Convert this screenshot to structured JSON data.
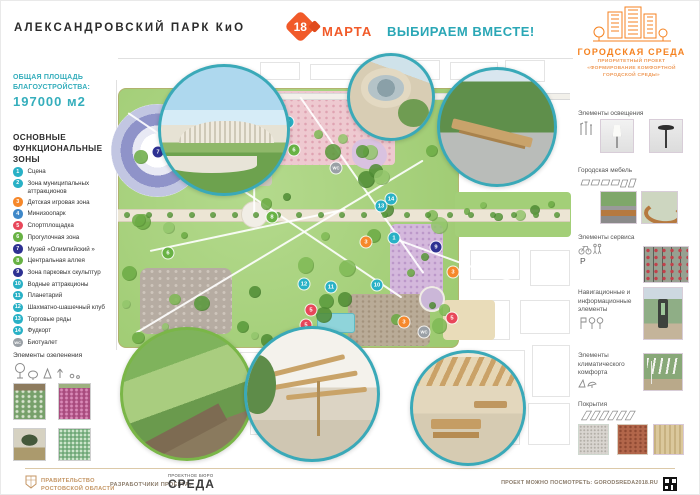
{
  "header": {
    "title": "АЛЕКСАНДРОВСКИЙ ПАРК КиО",
    "date_number": "18",
    "date_word": "МАРТА",
    "slogan": "ВЫБИРАЕМ ВМЕСТЕ!",
    "program_name": "ГОРОДСКАЯ СРЕДА",
    "program_subtitle": "ПРИОРИТЕТНЫЙ ПРОЕКТ «ФОРМИРОВАНИЕ КОМФОРТНОЙ ГОРОДСКОЙ СРЕДЫ»"
  },
  "left_panel": {
    "area_label": "ОБЩАЯ ПЛОЩАДЬ БЛАГОУСТРОЙСТВА:",
    "area_value": "197000 м2",
    "zones_heading": "ОСНОВНЫЕ ФУНКЦИОНАЛЬНЫЕ ЗОНЫ",
    "zones": [
      {
        "num": "1",
        "label": "Сцена",
        "color": "#29b1c6"
      },
      {
        "num": "2",
        "label": "Зона муниципальных аттракционов",
        "color": "#29b1c6"
      },
      {
        "num": "3",
        "label": "Детская игровая зона",
        "color": "#f6882b"
      },
      {
        "num": "4",
        "label": "Минизоопарк",
        "color": "#3f88c9"
      },
      {
        "num": "5",
        "label": "Спортплощадка",
        "color": "#e8475a"
      },
      {
        "num": "6",
        "label": "Прогулочная зона",
        "color": "#68b244"
      },
      {
        "num": "7",
        "label": "Музей «Олимпийский »",
        "color": "#2e3192"
      },
      {
        "num": "8",
        "label": "Центральная аллея",
        "color": "#68b244"
      },
      {
        "num": "9",
        "label": "Зона парковых скульптур",
        "color": "#2e3192"
      },
      {
        "num": "10",
        "label": "Водные аттракционы",
        "color": "#29b1c6"
      },
      {
        "num": "11",
        "label": "Планетарий",
        "color": "#29b1c6"
      },
      {
        "num": "12",
        "label": "Шахматно-шашечный клуб",
        "color": "#29b1c6"
      },
      {
        "num": "13",
        "label": "Торговые ряды",
        "color": "#29b1c6"
      },
      {
        "num": "14",
        "label": "Фудкорт",
        "color": "#29b1c6"
      },
      {
        "num": "WC",
        "label": "Биотуалет",
        "color": "#9aa0a6"
      }
    ],
    "greenery_label": "Элементы озеленения"
  },
  "right_panel": {
    "sections": [
      {
        "title": "Элементы освещения"
      },
      {
        "title": "Городская мебель"
      },
      {
        "title": "Элементы сервиса",
        "parking_letter": "Р"
      },
      {
        "title": "Навигационные и информационные элементы"
      },
      {
        "title": "Элементы климатического комфорта"
      },
      {
        "title": "Покрытия"
      }
    ]
  },
  "map": {
    "markers": [
      {
        "n": "7",
        "x": 158,
        "y": 152,
        "c": "#2e3192"
      },
      {
        "n": "2",
        "x": 288,
        "y": 122,
        "c": "#29b1c6"
      },
      {
        "n": "4",
        "x": 259,
        "y": 155,
        "c": "#3f88c9"
      },
      {
        "n": "6",
        "x": 294,
        "y": 150,
        "c": "#68b244"
      },
      {
        "n": "6",
        "x": 168,
        "y": 253,
        "c": "#68b244"
      },
      {
        "n": "8",
        "x": 272,
        "y": 217,
        "c": "#68b244"
      },
      {
        "n": "13",
        "x": 381,
        "y": 206,
        "c": "#29b1c6"
      },
      {
        "n": "14",
        "x": 391,
        "y": 199,
        "c": "#29b1c6"
      },
      {
        "n": "1",
        "x": 394,
        "y": 238,
        "c": "#29b1c6"
      },
      {
        "n": "3",
        "x": 366,
        "y": 242,
        "c": "#f6882b"
      },
      {
        "n": "9",
        "x": 436,
        "y": 247,
        "c": "#2e3192"
      },
      {
        "n": "3",
        "x": 453,
        "y": 272,
        "c": "#f6882b"
      },
      {
        "n": "10",
        "x": 377,
        "y": 285,
        "c": "#29b1c6"
      },
      {
        "n": "12",
        "x": 304,
        "y": 284,
        "c": "#29b1c6"
      },
      {
        "n": "11",
        "x": 331,
        "y": 287,
        "c": "#29b1c6"
      },
      {
        "n": "3",
        "x": 404,
        "y": 322,
        "c": "#f6882b"
      },
      {
        "n": "5",
        "x": 452,
        "y": 318,
        "c": "#e8475a"
      },
      {
        "n": "5",
        "x": 311,
        "y": 310,
        "c": "#e8475a"
      },
      {
        "n": "5",
        "x": 306,
        "y": 325,
        "c": "#e8475a"
      },
      {
        "n": "WC",
        "x": 336,
        "y": 168,
        "c": "#9aa0a6"
      },
      {
        "n": "WC",
        "x": 424,
        "y": 332,
        "c": "#9aa0a6"
      }
    ]
  },
  "footer": {
    "government": "ПРАВИТЕЛЬСТВО РОСТОВСКОЙ ОБЛАСТИ",
    "developers_label": "РАЗРАБОТЧИКИ ПРОЕКТА:",
    "bureau_top": "ПРОЕКТНОЕ БЮРО",
    "bureau_name": "СРЕДА",
    "link_label": "ПРОЕКТ МОЖНО ПОСМОТРЕТЬ: GORODSREDA2018.RU"
  },
  "colors": {
    "accent_teal": "#2aa7b6",
    "accent_orange": "#f15a29",
    "program_orange": "#f58220",
    "footer_tan": "#c49563"
  }
}
